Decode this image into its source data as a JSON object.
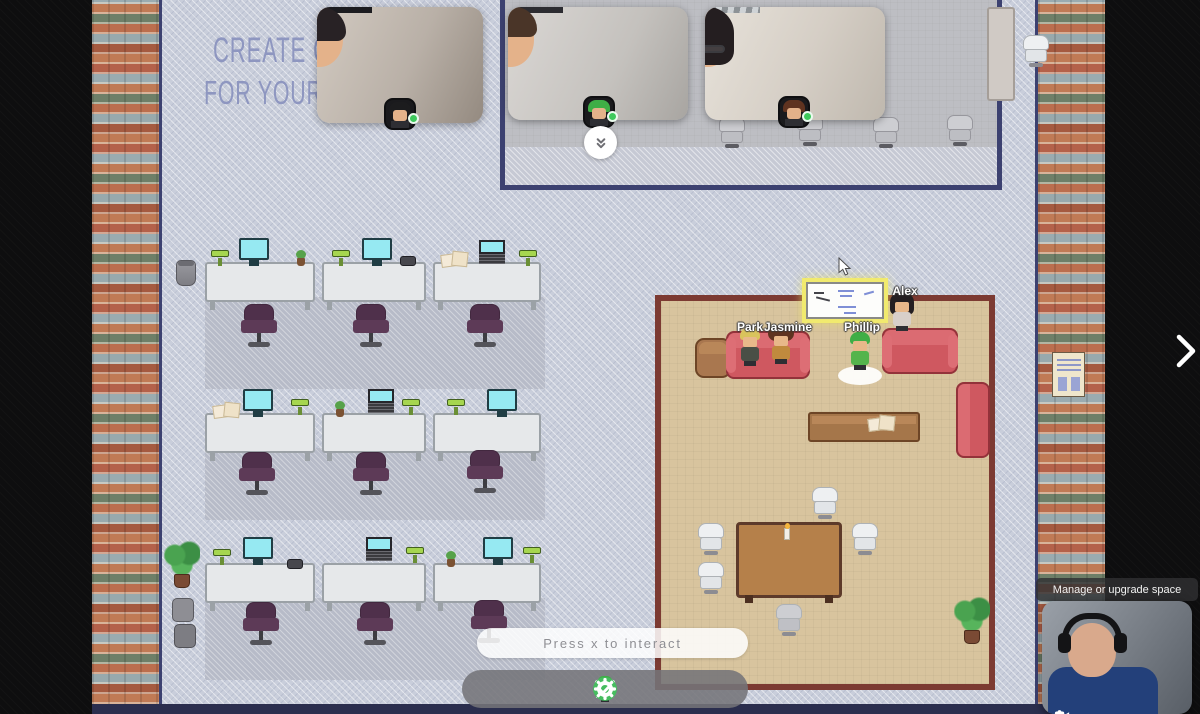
{
  "poster": {
    "line1": "CREATE CU",
    "line2": "FOR YOUR U"
  },
  "players": [
    {
      "name": "Park",
      "status": "online"
    },
    {
      "name": "Jasmine",
      "status": "online"
    },
    {
      "name": "Phillip",
      "status": "online"
    },
    {
      "name": "Alex",
      "status": "online"
    }
  ],
  "video_call": {
    "participants": [
      {
        "status": "online",
        "avatar_hair": "black"
      },
      {
        "status": "online",
        "avatar_hair": "green"
      },
      {
        "status": "online",
        "avatar_hair": "brown"
      }
    ],
    "collapse_icon": "double-chevron-down",
    "self_view_controls": [
      "microphone",
      "camera"
    ]
  },
  "hud": {
    "interaction_prompt": "Press x to interact",
    "space_tooltip": "Manage or upgrade space",
    "panel_toggle_icon": "chevron-right"
  },
  "toolbar": {
    "items": [
      {
        "icon": "avatar"
      },
      {
        "icon": "build-hammer"
      },
      {
        "icon": "map"
      },
      {
        "icon": "spotlight-bullseye"
      },
      {
        "icon": "screen-share-monitor"
      },
      {
        "icon": "raise-hand"
      },
      {
        "icon": "status-available-check"
      },
      {
        "icon": "settings-gear"
      }
    ]
  },
  "colors": {
    "status_green": "#3ec95c",
    "check_green": "#46bd5f",
    "highlight_yellow": "#f1ea6e",
    "room_wall": "#7c3a32",
    "room_floor": "#d8c49e",
    "map_floor": "#c9cedb",
    "video_room_border": "#3c4170"
  }
}
